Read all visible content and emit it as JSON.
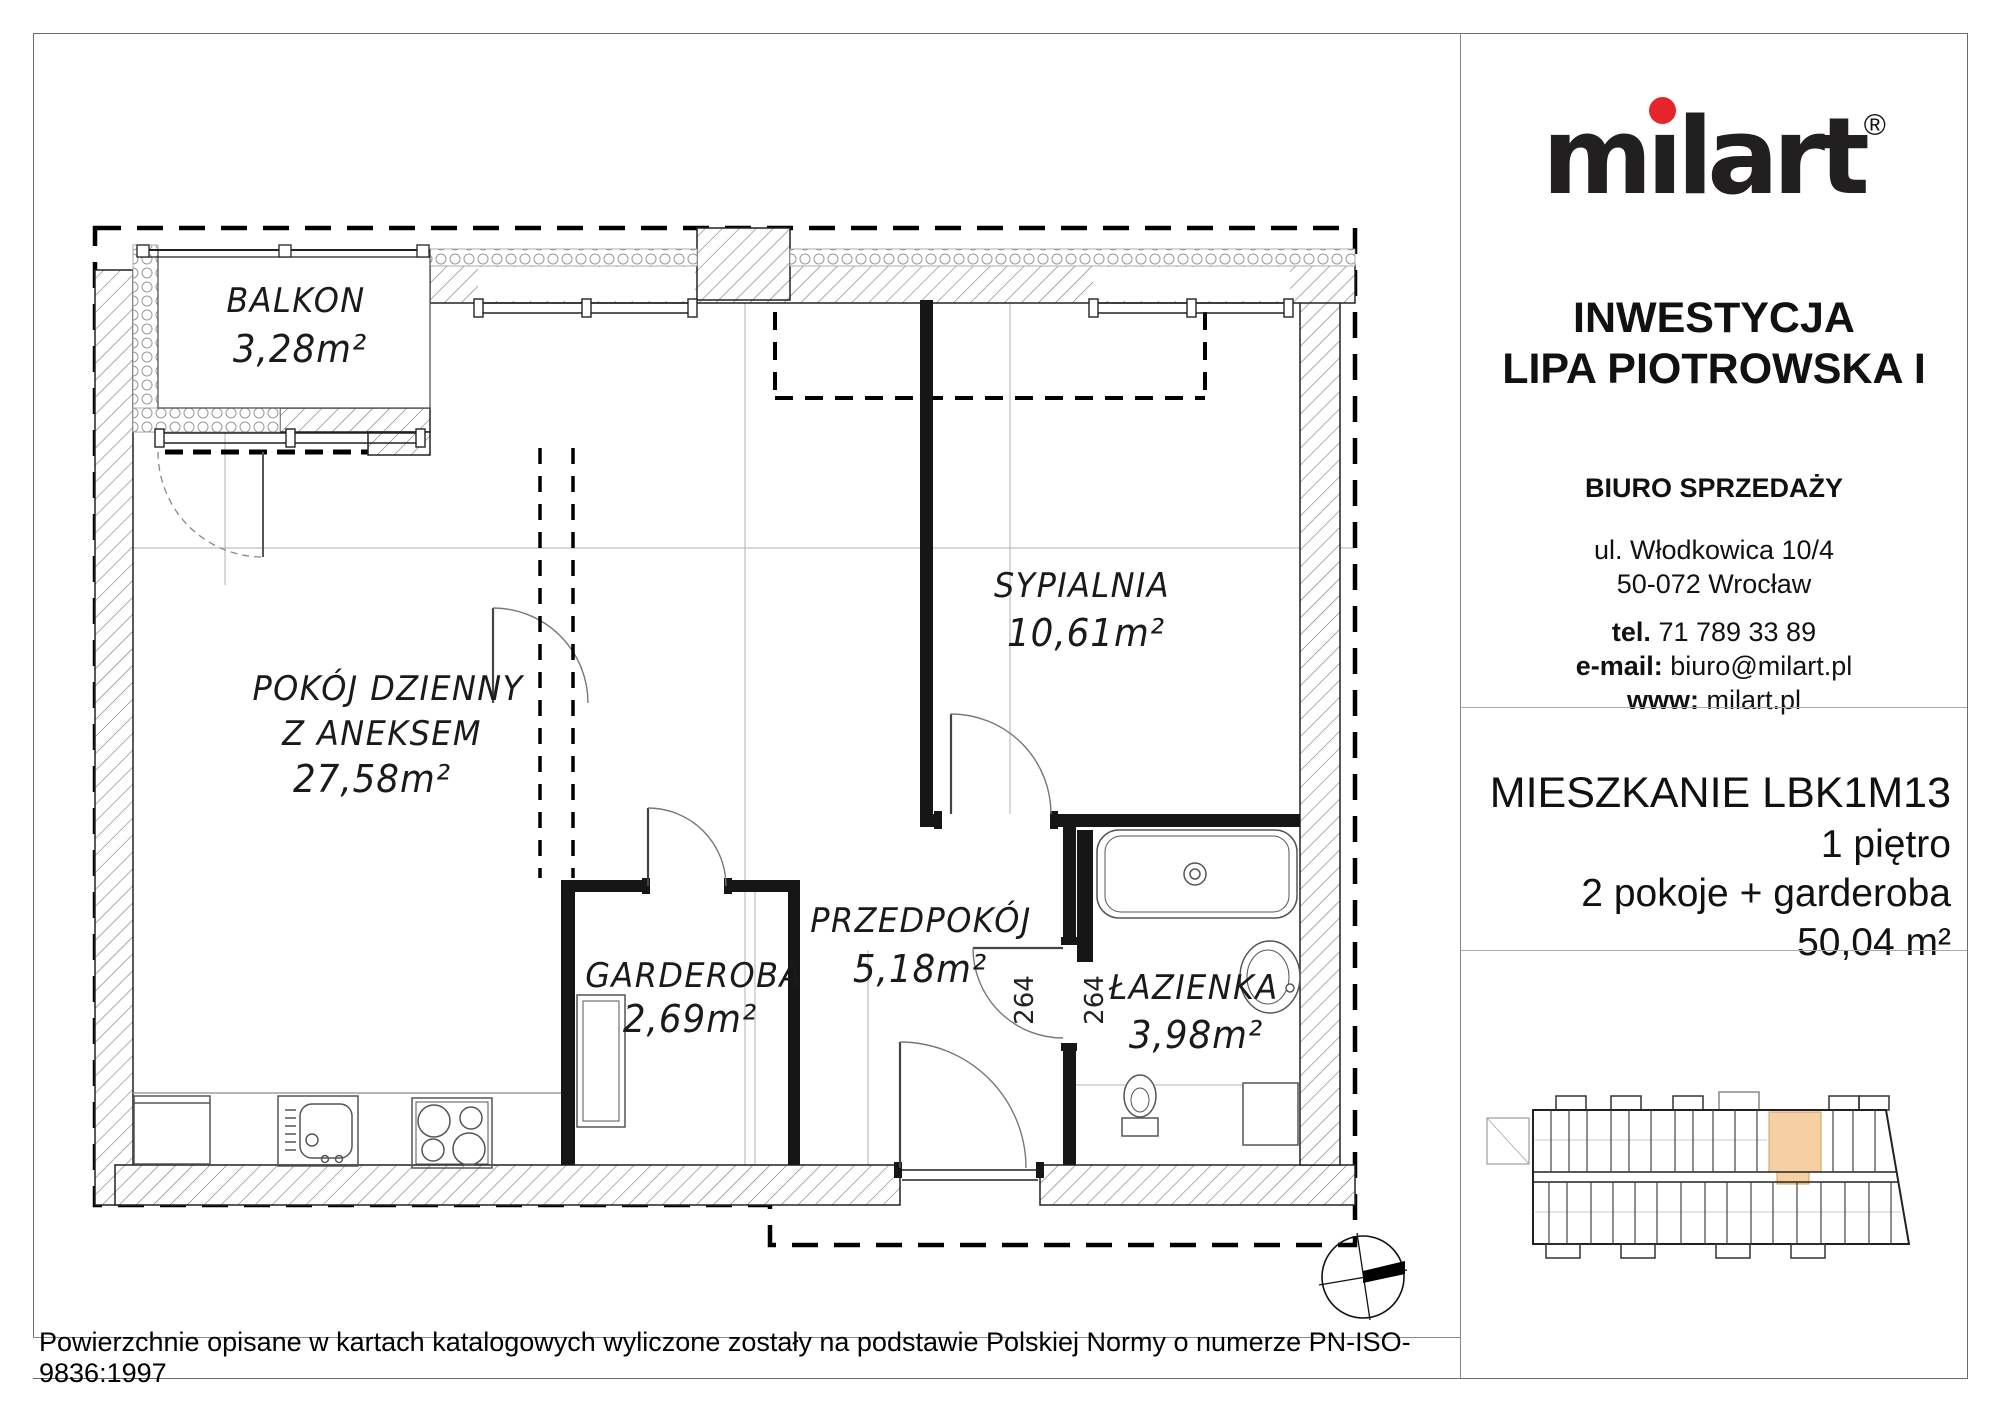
{
  "plan": {
    "rooms": [
      {
        "name": "BALKON",
        "area": "3,28m²"
      },
      {
        "name": "POKÓJ  DZIENNY",
        "name2": "Z  ANEKSEM",
        "area": "27,58m²"
      },
      {
        "name": "SYPIALNIA",
        "area": "10,61m²"
      },
      {
        "name": "GARDEROBA",
        "area": "2,69m²"
      },
      {
        "name": "PRZEDPOKÓJ",
        "area": "5,18m²"
      },
      {
        "name": "ŁAZIENKA",
        "area": "3,98m²"
      }
    ],
    "dimensions": [
      "264",
      "264"
    ]
  },
  "panel": {
    "logo": {
      "text": "milart",
      "text_pre": "m",
      "text_i": "ı",
      "text_post": "lart",
      "registered": "®",
      "dot_color": "#e5252c"
    },
    "investment": {
      "label": "INWESTYCJA",
      "name": "LIPA PIOTROWSKA I"
    },
    "office": {
      "title": "BIURO SPRZEDAŻY",
      "address_line1": "ul. Włodkowica 10/4",
      "address_line2": "50-072 Wrocław",
      "phone_label": "tel.",
      "phone": "71 789 33 89",
      "email_label": "e-mail:",
      "email": "biuro@milart.pl",
      "www_label": "www:",
      "www": "milart.pl"
    },
    "apartment": {
      "title": "MIESZKANIE LBK1M13",
      "floor": "1 piętro",
      "layout": "2 pokoje + garderoba",
      "area": "50,04 m²"
    },
    "minimap": {
      "highlight_color": "#f6d0a3"
    }
  },
  "footer": {
    "disclaimer": "Powierzchnie opisane w kartach katalogowych wyliczone zostały na podstawie  Polskiej Normy o numerze PN-ISO-9836:1997"
  }
}
